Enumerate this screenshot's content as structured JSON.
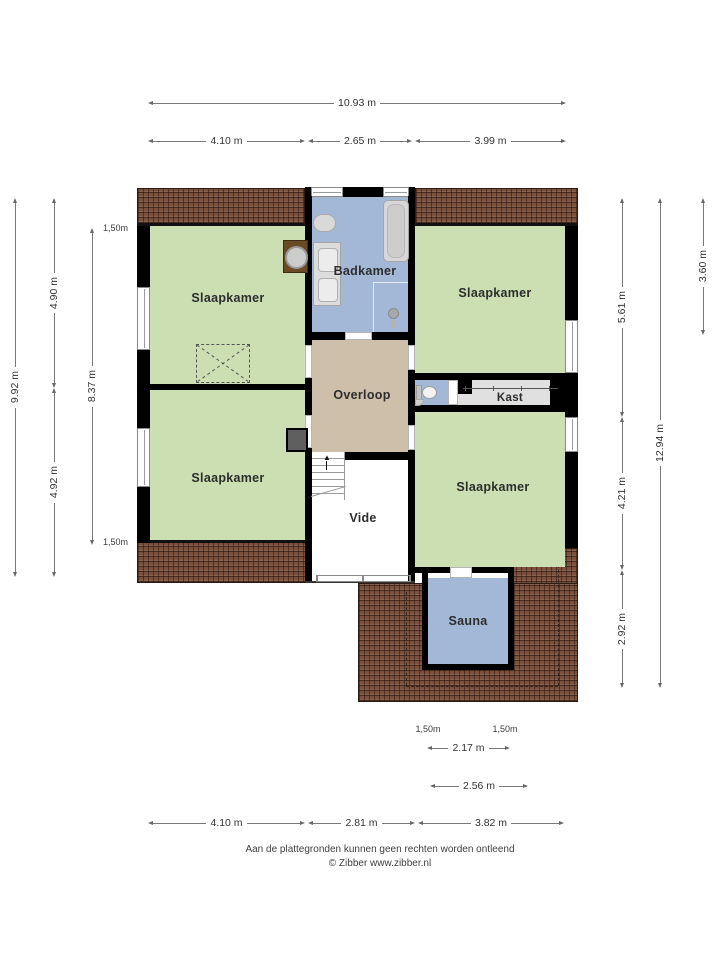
{
  "rooms": {
    "slaapkamer_tl": "Slaapkamer",
    "badkamer": "Badkamer",
    "slaapkamer_tr": "Slaapkamer",
    "overloop": "Overloop",
    "kast": "Kast",
    "slaapkamer_bl": "Slaapkamer",
    "vide": "Vide",
    "slaapkamer_br": "Slaapkamer",
    "sauna": "Sauna"
  },
  "dimensions": {
    "top_total": "10.93 m",
    "top_segments": [
      "4.10 m",
      "2.65 m",
      "3.99 m"
    ],
    "left_total": "9.92 m",
    "left_segments": [
      "4.90 m",
      "4.92 m"
    ],
    "left_inner": "8.37 m",
    "left_knee_top": "1,50m",
    "left_knee_bottom": "1,50m",
    "right_segments": [
      "5.61 m",
      "4.21 m",
      "2.92 m"
    ],
    "right_total": "12.94 m",
    "right_upper": "3.60 m",
    "bottom_knee_left": "1,50m",
    "bottom_knee_right": "1,50m",
    "bottom_sauna_inner": "2.17 m",
    "bottom_sauna_outer": "2.56 m",
    "bottom_segments": [
      "4.10 m",
      "2.81 m",
      "3.82 m"
    ]
  },
  "footer": {
    "disclaimer": "Aan de plattegronden kunnen geen rechten worden ontleend",
    "credit": "© Zibber www.zibber.nl"
  },
  "colors": {
    "room_green": "#cbdfb3",
    "wet_room_blue": "#a3b8d6",
    "hall_tan": "#cdbfaa",
    "closet_gray": "#e0e0e0",
    "roof_brown": "#7b513e",
    "wall_black": "#000000"
  }
}
